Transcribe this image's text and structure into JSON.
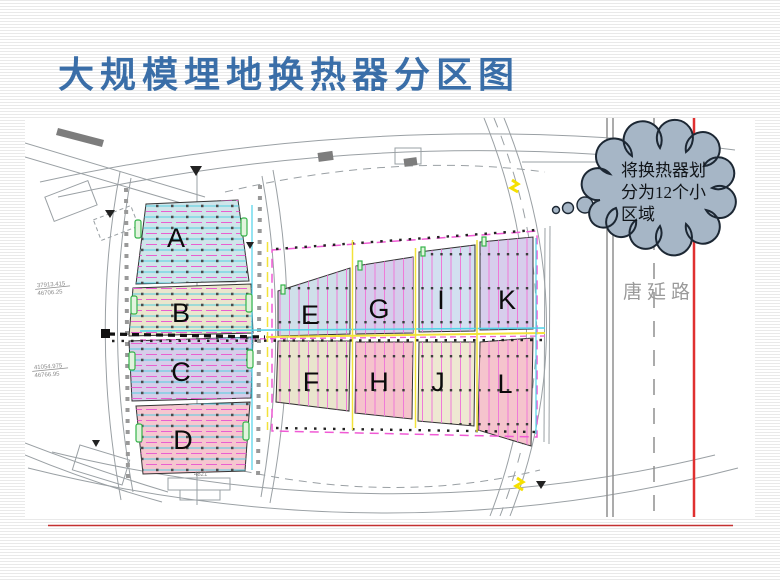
{
  "slide": {
    "title": "大规模埋地换热器分区图"
  },
  "cloud": {
    "full_text": "将换热器划分为12个小区域",
    "line1": "将换热器划",
    "line2": "分为12个小",
    "line3": "区域"
  },
  "road": {
    "name": "唐延路"
  },
  "zones": [
    {
      "id": "A",
      "label": "A",
      "fill": "#cfe5ea"
    },
    {
      "id": "B",
      "label": "B",
      "fill": "#eae6cd"
    },
    {
      "id": "C",
      "label": "C",
      "fill": "#d7cdea"
    },
    {
      "id": "D",
      "label": "D",
      "fill": "#f6c6cf"
    },
    {
      "id": "E",
      "label": "E",
      "fill": "#cfdfe9"
    },
    {
      "id": "F",
      "label": "F",
      "fill": "#e9e5cd"
    },
    {
      "id": "G",
      "label": "G",
      "fill": "#d5cdeb"
    },
    {
      "id": "H",
      "label": "H",
      "fill": "#f5c3cc"
    },
    {
      "id": "I",
      "label": "I",
      "fill": "#d2e0f0"
    },
    {
      "id": "J",
      "label": "J",
      "fill": "#eee8d2"
    },
    {
      "id": "K",
      "label": "K",
      "fill": "#d7ceec"
    },
    {
      "id": "L",
      "label": "L",
      "fill": "#f5c4cd"
    }
  ],
  "annotations": {
    "dim1a": "37913.415",
    "dim1b": "46706.25",
    "dim2a": "41054.975",
    "dim2b": "46766.95",
    "dim3": "4821"
  },
  "colors": {
    "title": "#3a6ea8",
    "cloud_fill": "#a6b6c6",
    "red_line": "#d32f2f",
    "magenta": "#ee5fd5",
    "yellow": "#f2e23a",
    "cyan": "#4fd2e8"
  }
}
